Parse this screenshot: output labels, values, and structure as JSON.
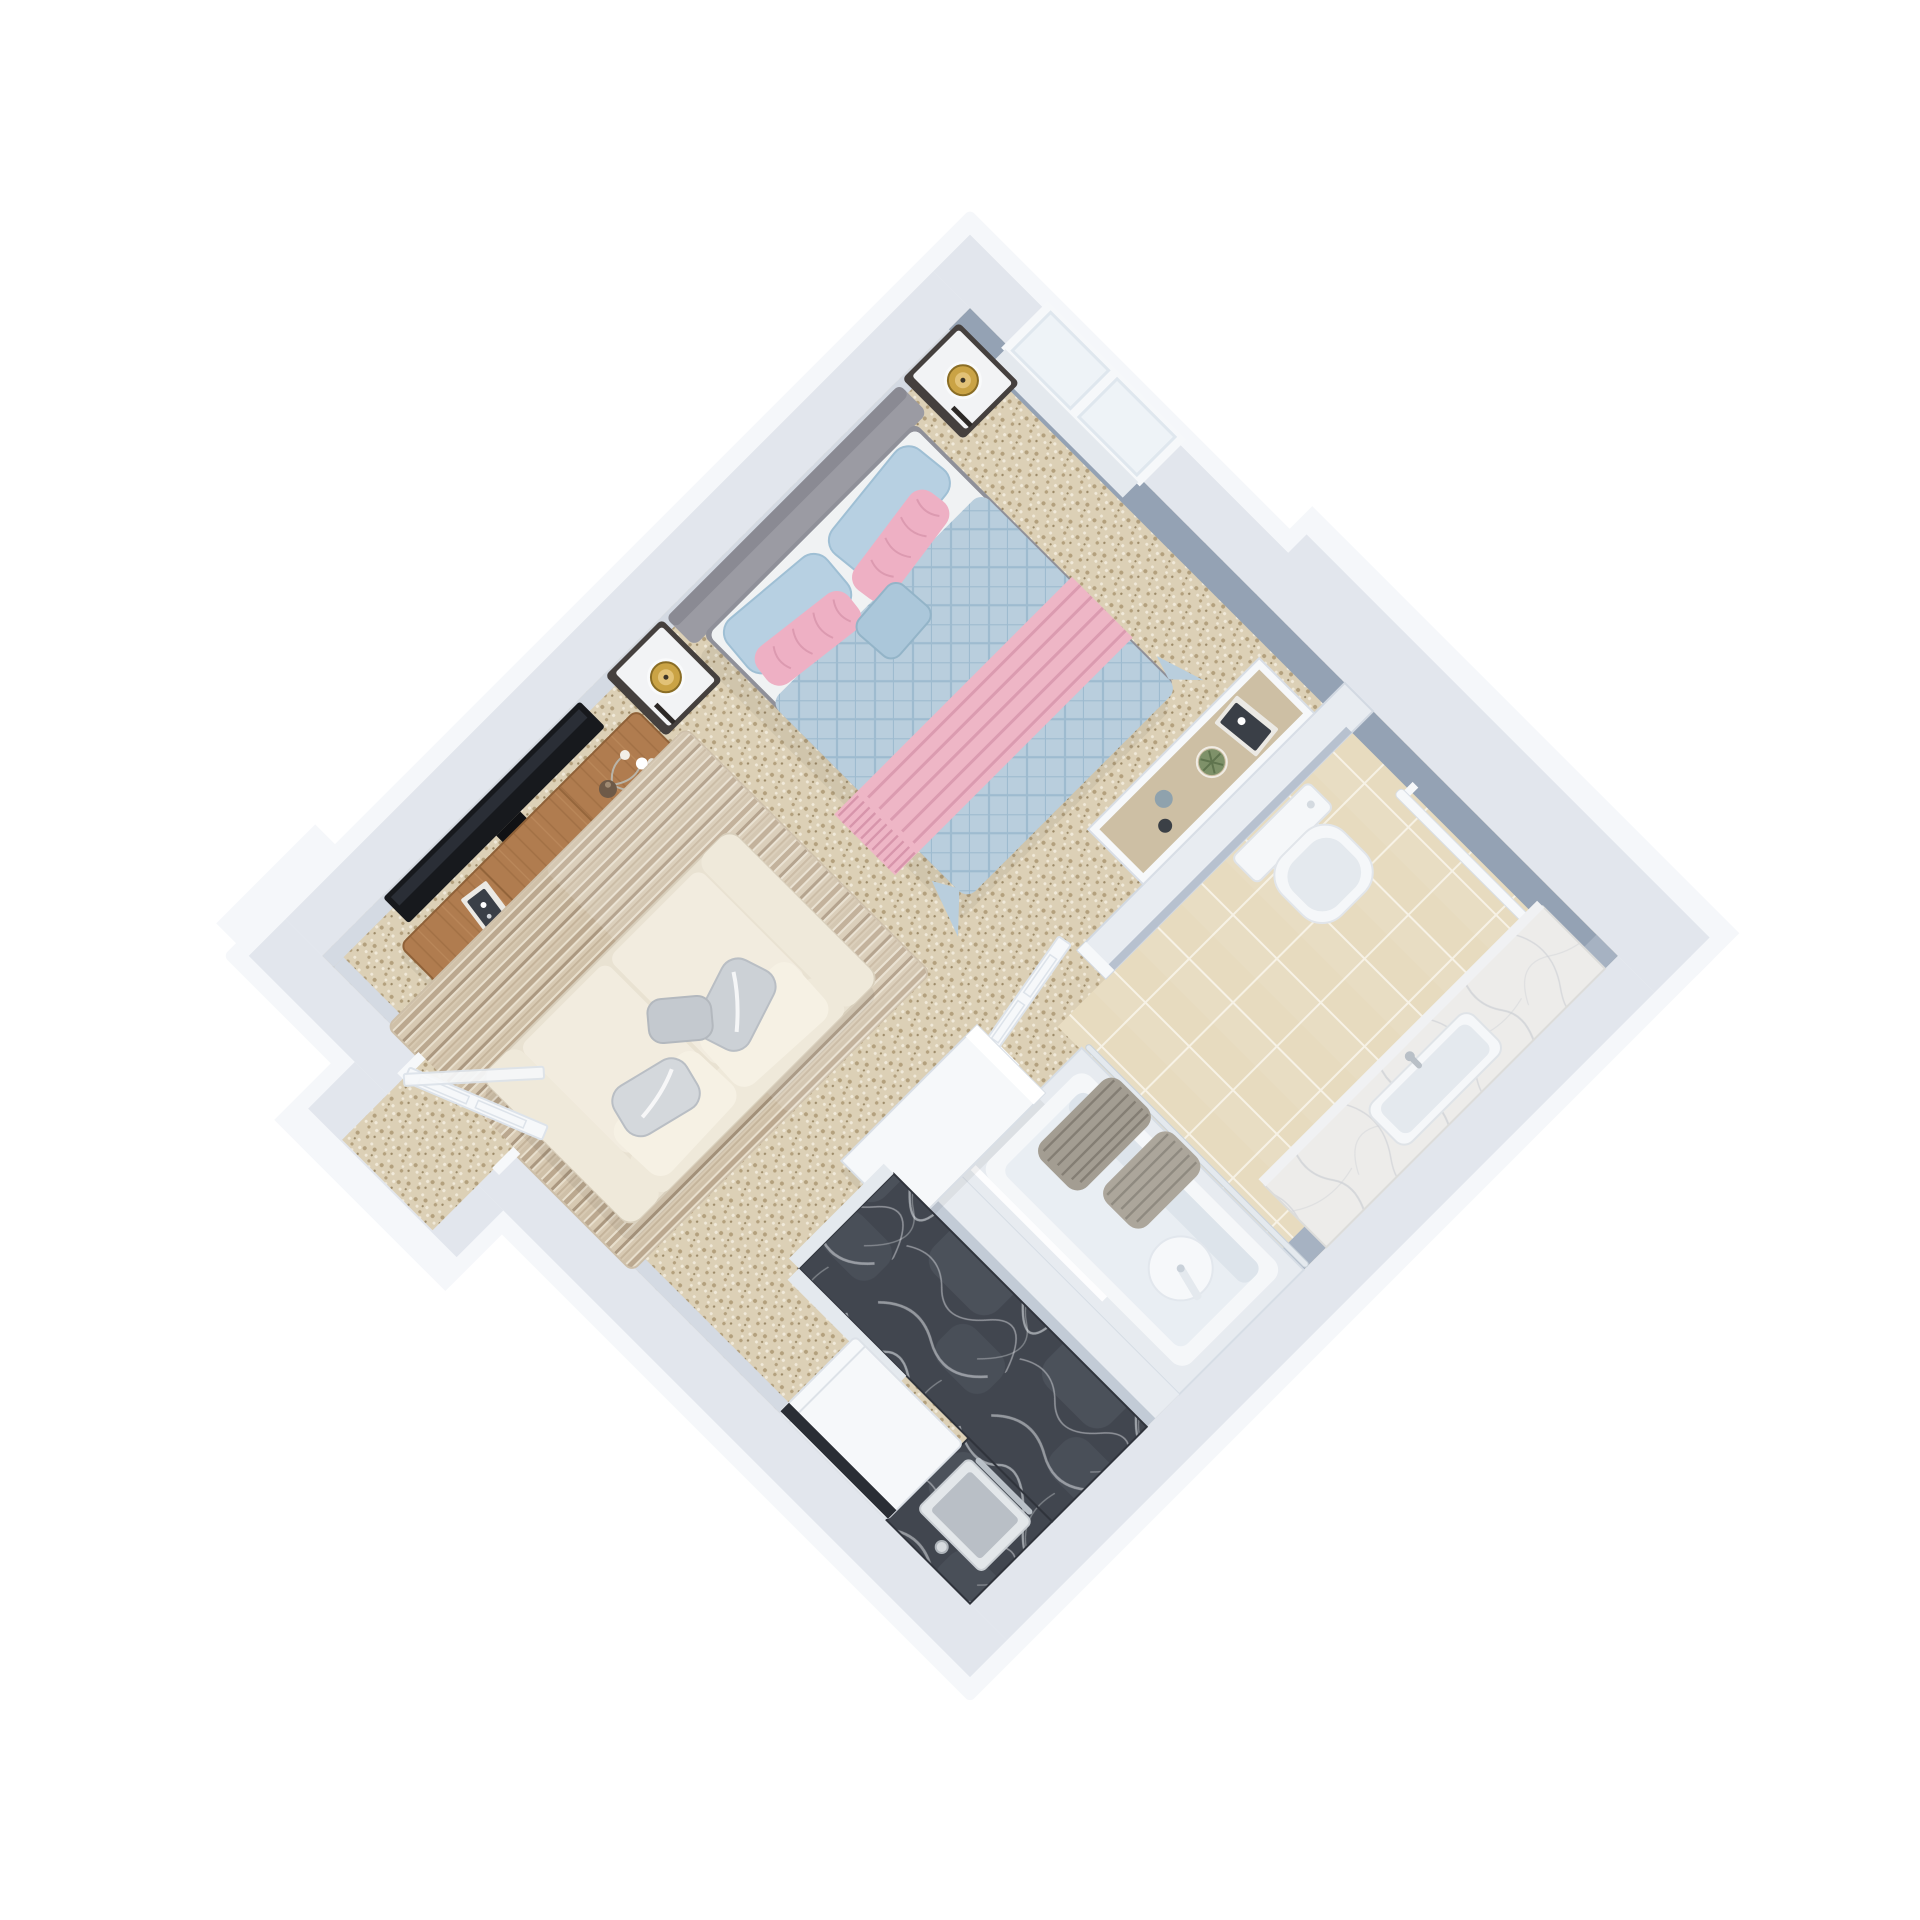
{
  "scene": {
    "type": "3d-isometric-floor-plan-render",
    "description": "Top-down 3D render of a studio apartment rotated 45 degrees on a white background",
    "rotation_deg": 45,
    "background": "#ffffff"
  },
  "colors": {
    "wall_top": "#e2e6ed",
    "wall_outer": "#f5f7fa",
    "wall_face_shaded": "#94a2b4",
    "wall_face_shaded_light": "#a6b2c2",
    "wall_face_light": "#d4dae3",
    "partition": "#e8ecf1",
    "carpet": "#dcd0b6",
    "carpet_speck_dark": "#b3a07d",
    "carpet_speck_light": "#f0e9d9",
    "tile": "#e7dbbf",
    "tile_grout": "#f6f1e4",
    "rug_base": "#d7c9b2",
    "rug_stripe_dark": "#ab9880",
    "rug_stripe_light": "#e8dfcd",
    "wood": "#b07c4f",
    "wood_grain": "#8f6138",
    "tv_black": "#17191d",
    "headboard_gray": "#9b9ba3",
    "bed_sheet": "#e9ebec",
    "duvet_blue": "#b9cedd",
    "duvet_quilt_line": "#9cb9cd",
    "runner_pink": "#eeb6c6",
    "runner_stripe": "#d795ab",
    "pillow_blue": "#b7d0e2",
    "pillow_pink": "#eeb0c4",
    "cushion_blue": "#abc7da",
    "sofa_cream": "#e9e2d2",
    "sofa_cushion": "#f2ecdf",
    "pillow_silver": "#ccd1d6",
    "nightstand_dark": "#45403e",
    "nightstand_top": "#f2f3f5",
    "lamp_gold": "#caa345",
    "lamp_gold_light": "#e2c277",
    "marble_dark": "#41464f",
    "marble_dark_vein": "#e7eaee",
    "marble_white": "#edecea",
    "marble_white_vein": "#cfd2d6",
    "curtain_gray": "#a39d92",
    "fixture_white": "#f5f7f9",
    "fixture_shadow": "#e4e9ee",
    "steel": "#b9c0c7",
    "sink_basin": "#b9bfc6",
    "appliance_slot": "#2a2e35",
    "door_white": "#f6f8fa",
    "door_edge": "#dde3ea",
    "plant_green": "#7e9169",
    "plant_green_dark": "#5f744e",
    "vase_blue_gray": "#8fa2ad",
    "vase_dark": "#3b4046",
    "book_dark": "#3a3f47",
    "book_light": "#ebe9e4",
    "glass": "#eef3f7"
  },
  "rooms": [
    {
      "id": "living-bedroom",
      "name": "combined bedroom and living area",
      "floor": "beige speckled carpet"
    },
    {
      "id": "bathroom",
      "name": "bathroom",
      "floor": "beige ceramic tile with white grout"
    },
    {
      "id": "kitchen-nook",
      "name": "kitchen nook",
      "floor": "beige speckled carpet"
    },
    {
      "id": "entrance",
      "name": "recessed entrance",
      "floor": "beige speckled carpet"
    }
  ],
  "furniture": {
    "bed": {
      "size": "double",
      "headboard": "gray upholstered",
      "duvet": "light blue diamond-quilted",
      "runner": "pink striped throw with fringe",
      "pillows": "2 blue, 2 pink ruffled, 1 small light blue"
    },
    "nightstands": {
      "count": 2,
      "body": "dark espresso",
      "top": "white",
      "lamp": "brass/gold"
    },
    "tv": {
      "mounted": "wall",
      "color": "black"
    },
    "media_console": {
      "material": "wood",
      "items": "white flower vase, books"
    },
    "sofa": {
      "seats": 2,
      "color": "cream",
      "pillows": "silver satin"
    },
    "rug": {
      "style": "striped",
      "tones": "taupe and cream"
    },
    "bathroom": {
      "toilet": "white modern back-to-wall",
      "vanity": "white marble counter with under-mount sink",
      "bathtub": "white built-in with round white shower plate",
      "shower_curtain": "gray, bunched on chrome rail",
      "towel_rail": "white, on wall",
      "storage_console": "white unit with tan top, books, succulent plant, two vases"
    },
    "kitchen": {
      "counter": "L-shaped dark gray marble",
      "sink": "square inset with bar faucet and dial",
      "appliance": "white cabinet appliance with dark slot"
    },
    "doors": {
      "entrance_door": "white, swung open inward",
      "bathroom_door": "white paneled, swung wide open"
    },
    "window": {
      "panes": 2,
      "frame": "white",
      "location": "upper-right exterior wall near top corner"
    }
  }
}
